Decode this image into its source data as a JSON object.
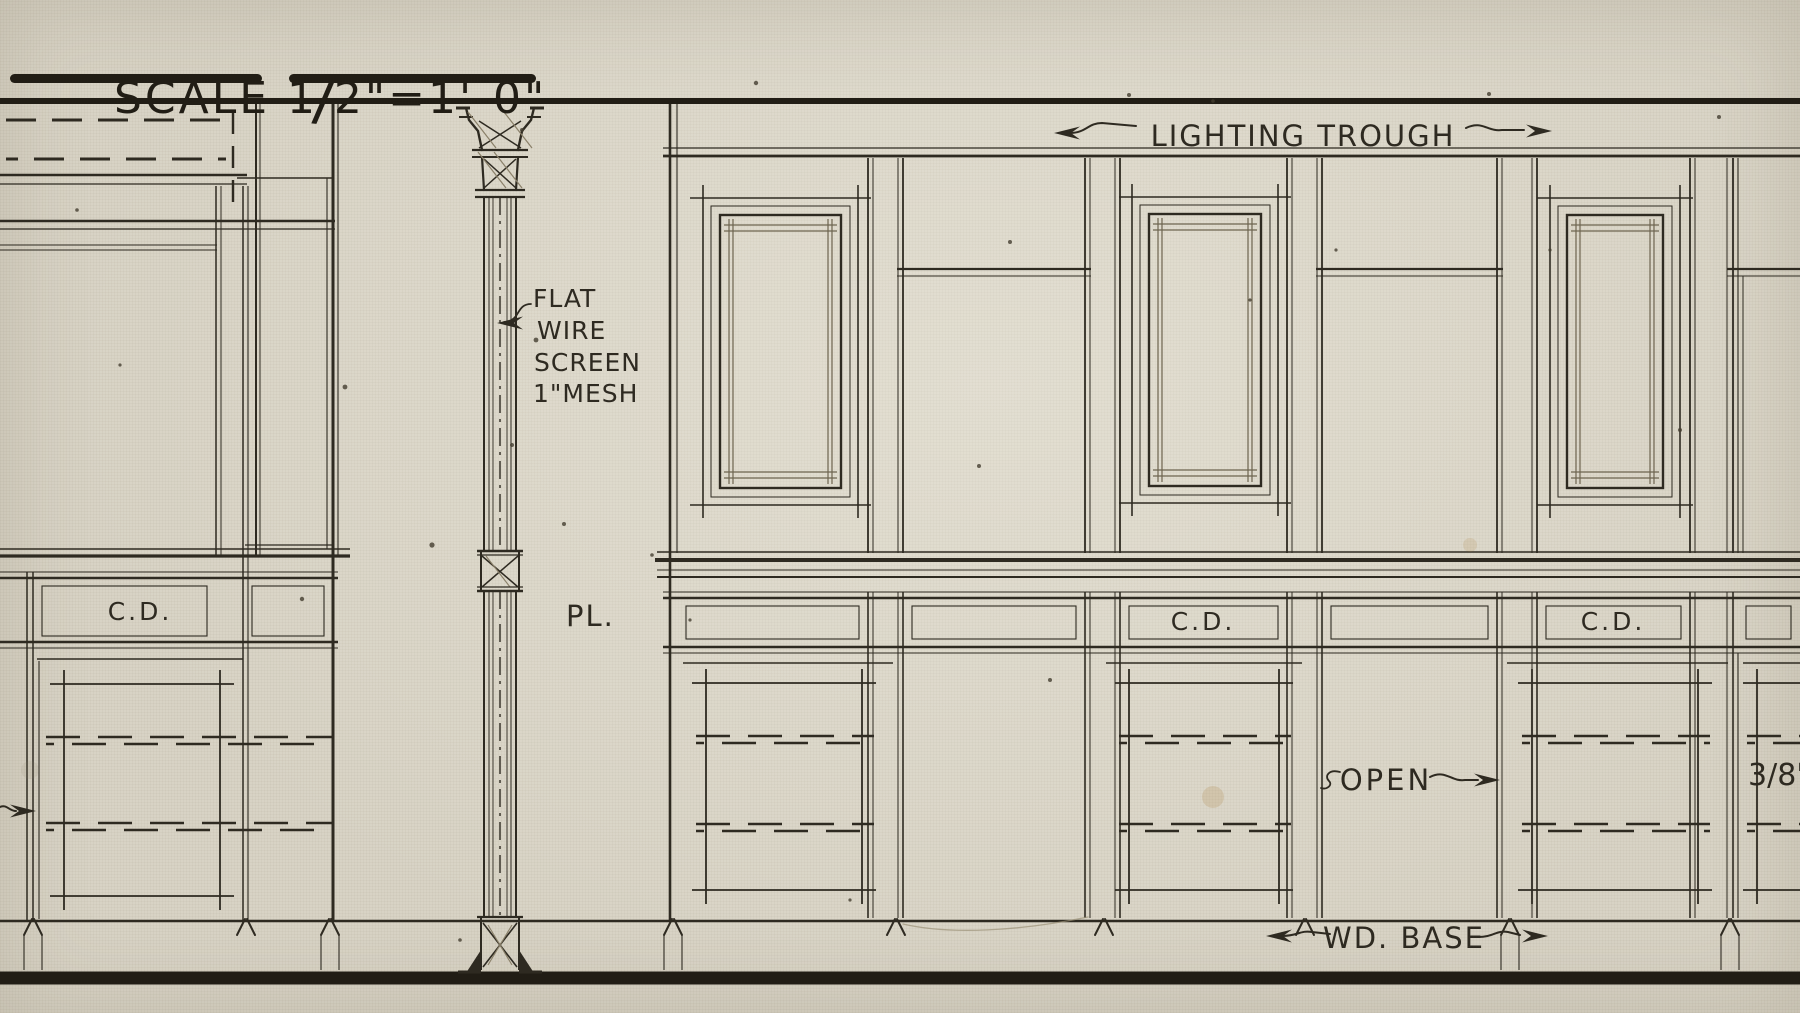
{
  "scale_note": {
    "part1": "SCALE 1",
    "slash": "/",
    "part2": "2\"=1'-0\""
  },
  "labels": {
    "lighting_trough": "LIGHTING TROUGH",
    "screen_line1": "FLAT",
    "screen_line2": "WIRE",
    "screen_line3": "SCREEN",
    "screen_line4": "1\"MESH",
    "plate": "PL.",
    "cd_left": "C.D.",
    "cd_mid": "C.D.",
    "cd_right": "C.D.",
    "open": "OPEN",
    "dimension": "3/8\"",
    "wood_base": "WD. BASE"
  },
  "colors": {
    "paper": "#d8d3c5",
    "ink": "#2e2a21",
    "heavy_ink": "#211d15",
    "pencil": "#8a8069",
    "pencil_dark": "#6e6550"
  }
}
